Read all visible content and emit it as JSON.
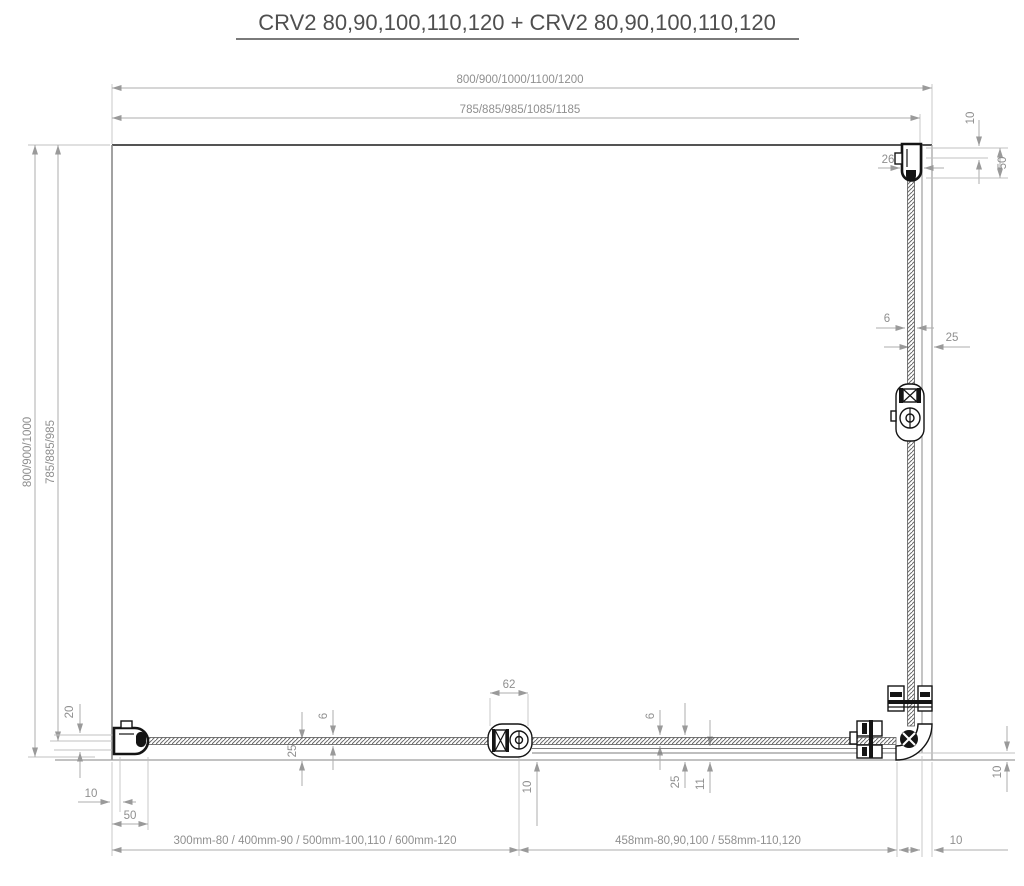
{
  "title": "CRV2 80,90,100,110,120 + CRV2 80,90,100,110,120",
  "dims": {
    "top_total": "800/900/1000/1100/1200",
    "top_glass": "785/885/985/1085/1185",
    "left_total": "800/900/1000",
    "left_glass": "785/885/985",
    "wall_profile_width": "26",
    "top_right_wall_offset": "10",
    "top_right_profile_height": "50",
    "right_glass_thickness": "6",
    "right_glass_offset": "25",
    "hinge_width": "62",
    "hinge_floor_gap": "10",
    "bottom_left_glass_thickness": "6",
    "bottom_left_glass_offset": "25",
    "bottom_right_glass_thickness": "6",
    "bottom_right_glass_offset": "25",
    "door_profile_offset": "11",
    "tray_edge_offset": "10",
    "left_profile_adjust": "20",
    "left_wall_glass_gap": "10",
    "left_profile_length": "50",
    "fixed_panel_width": "300mm-80 / 400mm-90 / 500mm-100,110 / 600mm-120",
    "door_panel_width": "458mm-80,90,100 / 558mm-110,120",
    "corner_edge_gap": "10"
  },
  "colors": {
    "background": "#ffffff",
    "wall_line": "#3c3c3c",
    "dimension_line": "#aeaeae",
    "dimension_text": "#8f8f8f",
    "hardware": "#141414"
  }
}
